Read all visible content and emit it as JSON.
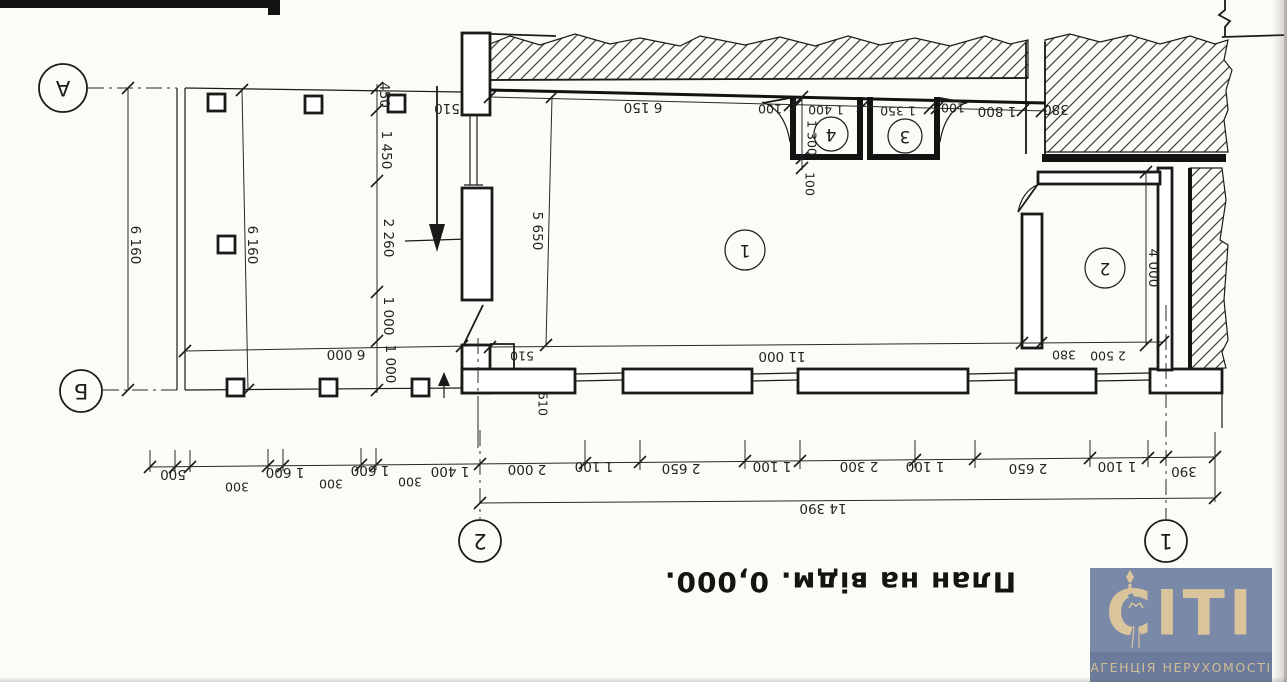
{
  "title": "План на відм. 0,000.",
  "grid": {
    "a": "А",
    "b": "Б",
    "one": "1",
    "two": "2"
  },
  "rooms": {
    "r1": "1",
    "r2": "2",
    "r3": "3",
    "r4": "4"
  },
  "dims": {
    "wall_thickness_top": "510",
    "top_chain": [
      "6 150",
      "100",
      "1 400",
      "1 350",
      "100",
      "1 800",
      "380"
    ],
    "room4_depth": "1 300",
    "room4_partition": "100",
    "left_chain": [
      "450",
      "1 450",
      "2 260",
      "1 000",
      "1 000"
    ],
    "terrace_depth_outer": "6 160",
    "terrace_depth_inner": "6 160",
    "terrace_width": "6 000",
    "room1_depth": "5 650",
    "room2_depth": "4 000",
    "step_width": "510",
    "room1_width": "11 000",
    "room2_wall": "380",
    "room2_width": "2 500",
    "wall_thickness_bottom": "510",
    "bottom_chain": [
      "500",
      "300",
      "1 600",
      "300",
      "1 600",
      "300",
      "1 400",
      "2 000",
      "1 100",
      "2 650",
      "1 100",
      "2 300",
      "1 100",
      "2 650",
      "1 100",
      "390"
    ],
    "overall_width": "14 390"
  },
  "logo": {
    "brand": "CITI",
    "tagline": "АГЕНЦІЯ НЕРУХОМОСТІ",
    "bg_color": "#7a89a8",
    "band_color": "#6c7b9c",
    "text_color": "#d9c49c"
  }
}
